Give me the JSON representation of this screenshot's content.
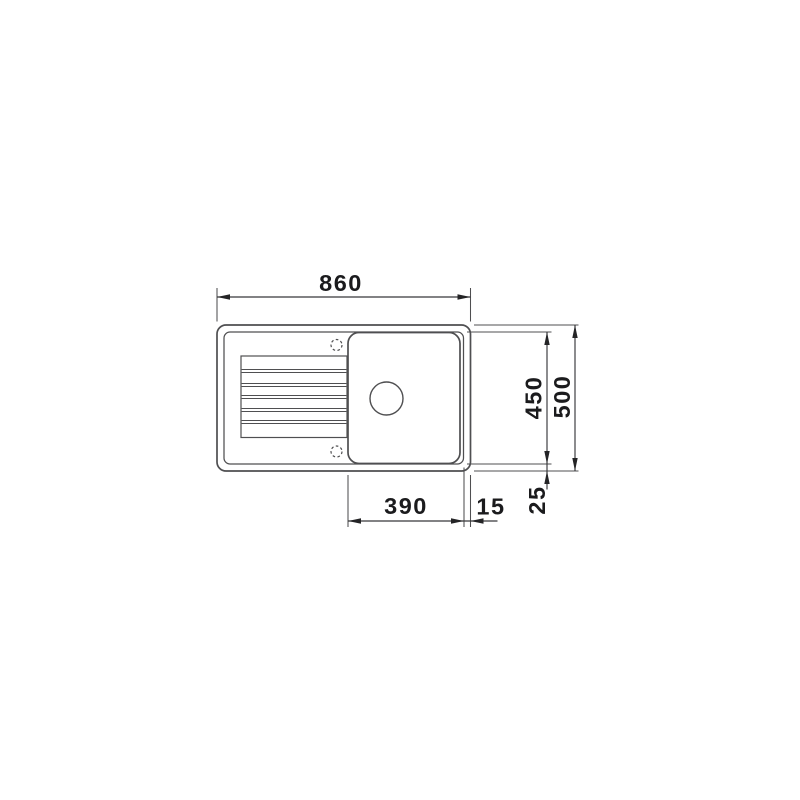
{
  "drawing": {
    "line_color": "#4f4f51",
    "dimension_line_color": "#38383a",
    "text_color": "#1b1b1d",
    "background": "#ffffff",
    "labels": {
      "overall_width": "860",
      "bowl_height": "450",
      "overall_height": "500",
      "bowl_width": "390",
      "edge_gap": "15",
      "rim_margin": "25"
    }
  }
}
